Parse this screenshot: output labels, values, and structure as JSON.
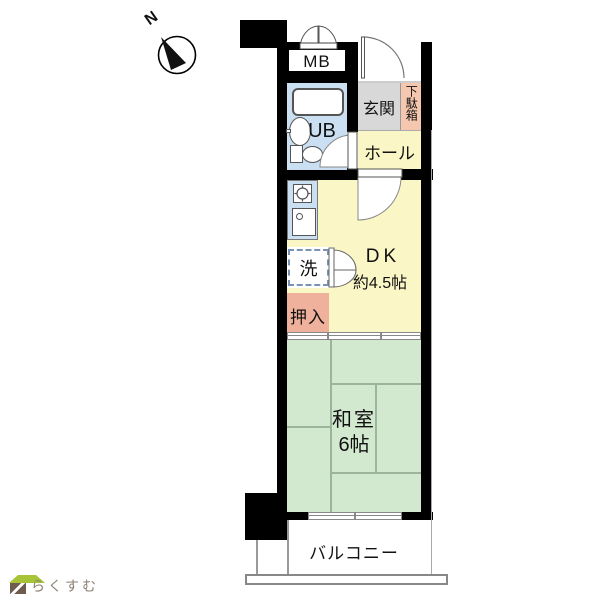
{
  "compass": {
    "north_label": "N"
  },
  "rooms": {
    "mb": "MB",
    "ub": "UB",
    "genkan": "玄関",
    "getabako": "下駄箱",
    "hall": "ホール",
    "dk_name": "DK",
    "dk_size": "約4.5帖",
    "laundry": "洗",
    "oshiire": "押入",
    "washitsu_name": "和室",
    "washitsu_size": "6帖",
    "balcony": "バルコニー"
  },
  "logo": {
    "text": "らくすむ"
  },
  "colors": {
    "wall": "#000000",
    "dk_yellow": "#faf6c5",
    "tatami_green": "#d2e8cf",
    "bath_blue": "#cadff1",
    "genkan_gray": "#d8d8d8",
    "getabako_pink": "#f4c7ae",
    "oshiire_pink": "#efb09c",
    "tatami_line": "#9cb49c",
    "logo_text_brown": "#8d8073",
    "logo_roof_green": "#a6c436",
    "logo_body_brown": "#6f5c4d"
  }
}
